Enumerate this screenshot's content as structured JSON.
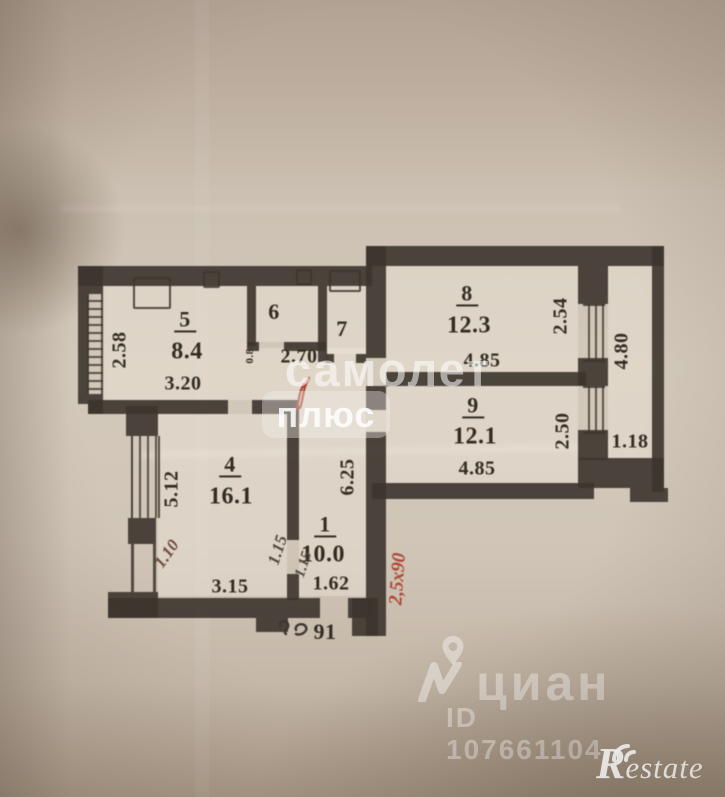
{
  "photo": {
    "paper_color": "#d2c7b9",
    "wall_color": "#3a322a",
    "red_ink_color": "#b0432e"
  },
  "plan": {
    "rooms": {
      "r1": {
        "num": "1",
        "area": "10.0",
        "width": "1.62",
        "height": "6.25"
      },
      "r4": {
        "num": "4",
        "area": "16.1",
        "width": "3.15",
        "height": "5.12"
      },
      "r5": {
        "num": "5",
        "area": "8.4",
        "width": "3.20",
        "height": "2.58"
      },
      "r6": {
        "num": "6"
      },
      "r7": {
        "num": "7"
      },
      "r8": {
        "num": "8",
        "area": "12.3",
        "width": "4.85",
        "height": "2.54"
      },
      "r9": {
        "num": "9",
        "area": "12.1",
        "width": "4.85",
        "height": "2.50"
      }
    },
    "corridor": {
      "width": "2.70",
      "door": "0.8"
    },
    "balcony": {
      "height": "4.80",
      "width": "1.18"
    },
    "handwritten": {
      "left": "1.10",
      "door_a": "1.15",
      "door_b": "1.15",
      "red_note": "2,5х90"
    },
    "apartment_number": "91"
  },
  "watermarks": {
    "samolet": {
      "line1": "самолет",
      "line2": "плюс"
    },
    "cian": {
      "name": "циан",
      "listing_id": "ID 107661104"
    },
    "restate": {
      "r": "R",
      "rest": "estate"
    }
  }
}
